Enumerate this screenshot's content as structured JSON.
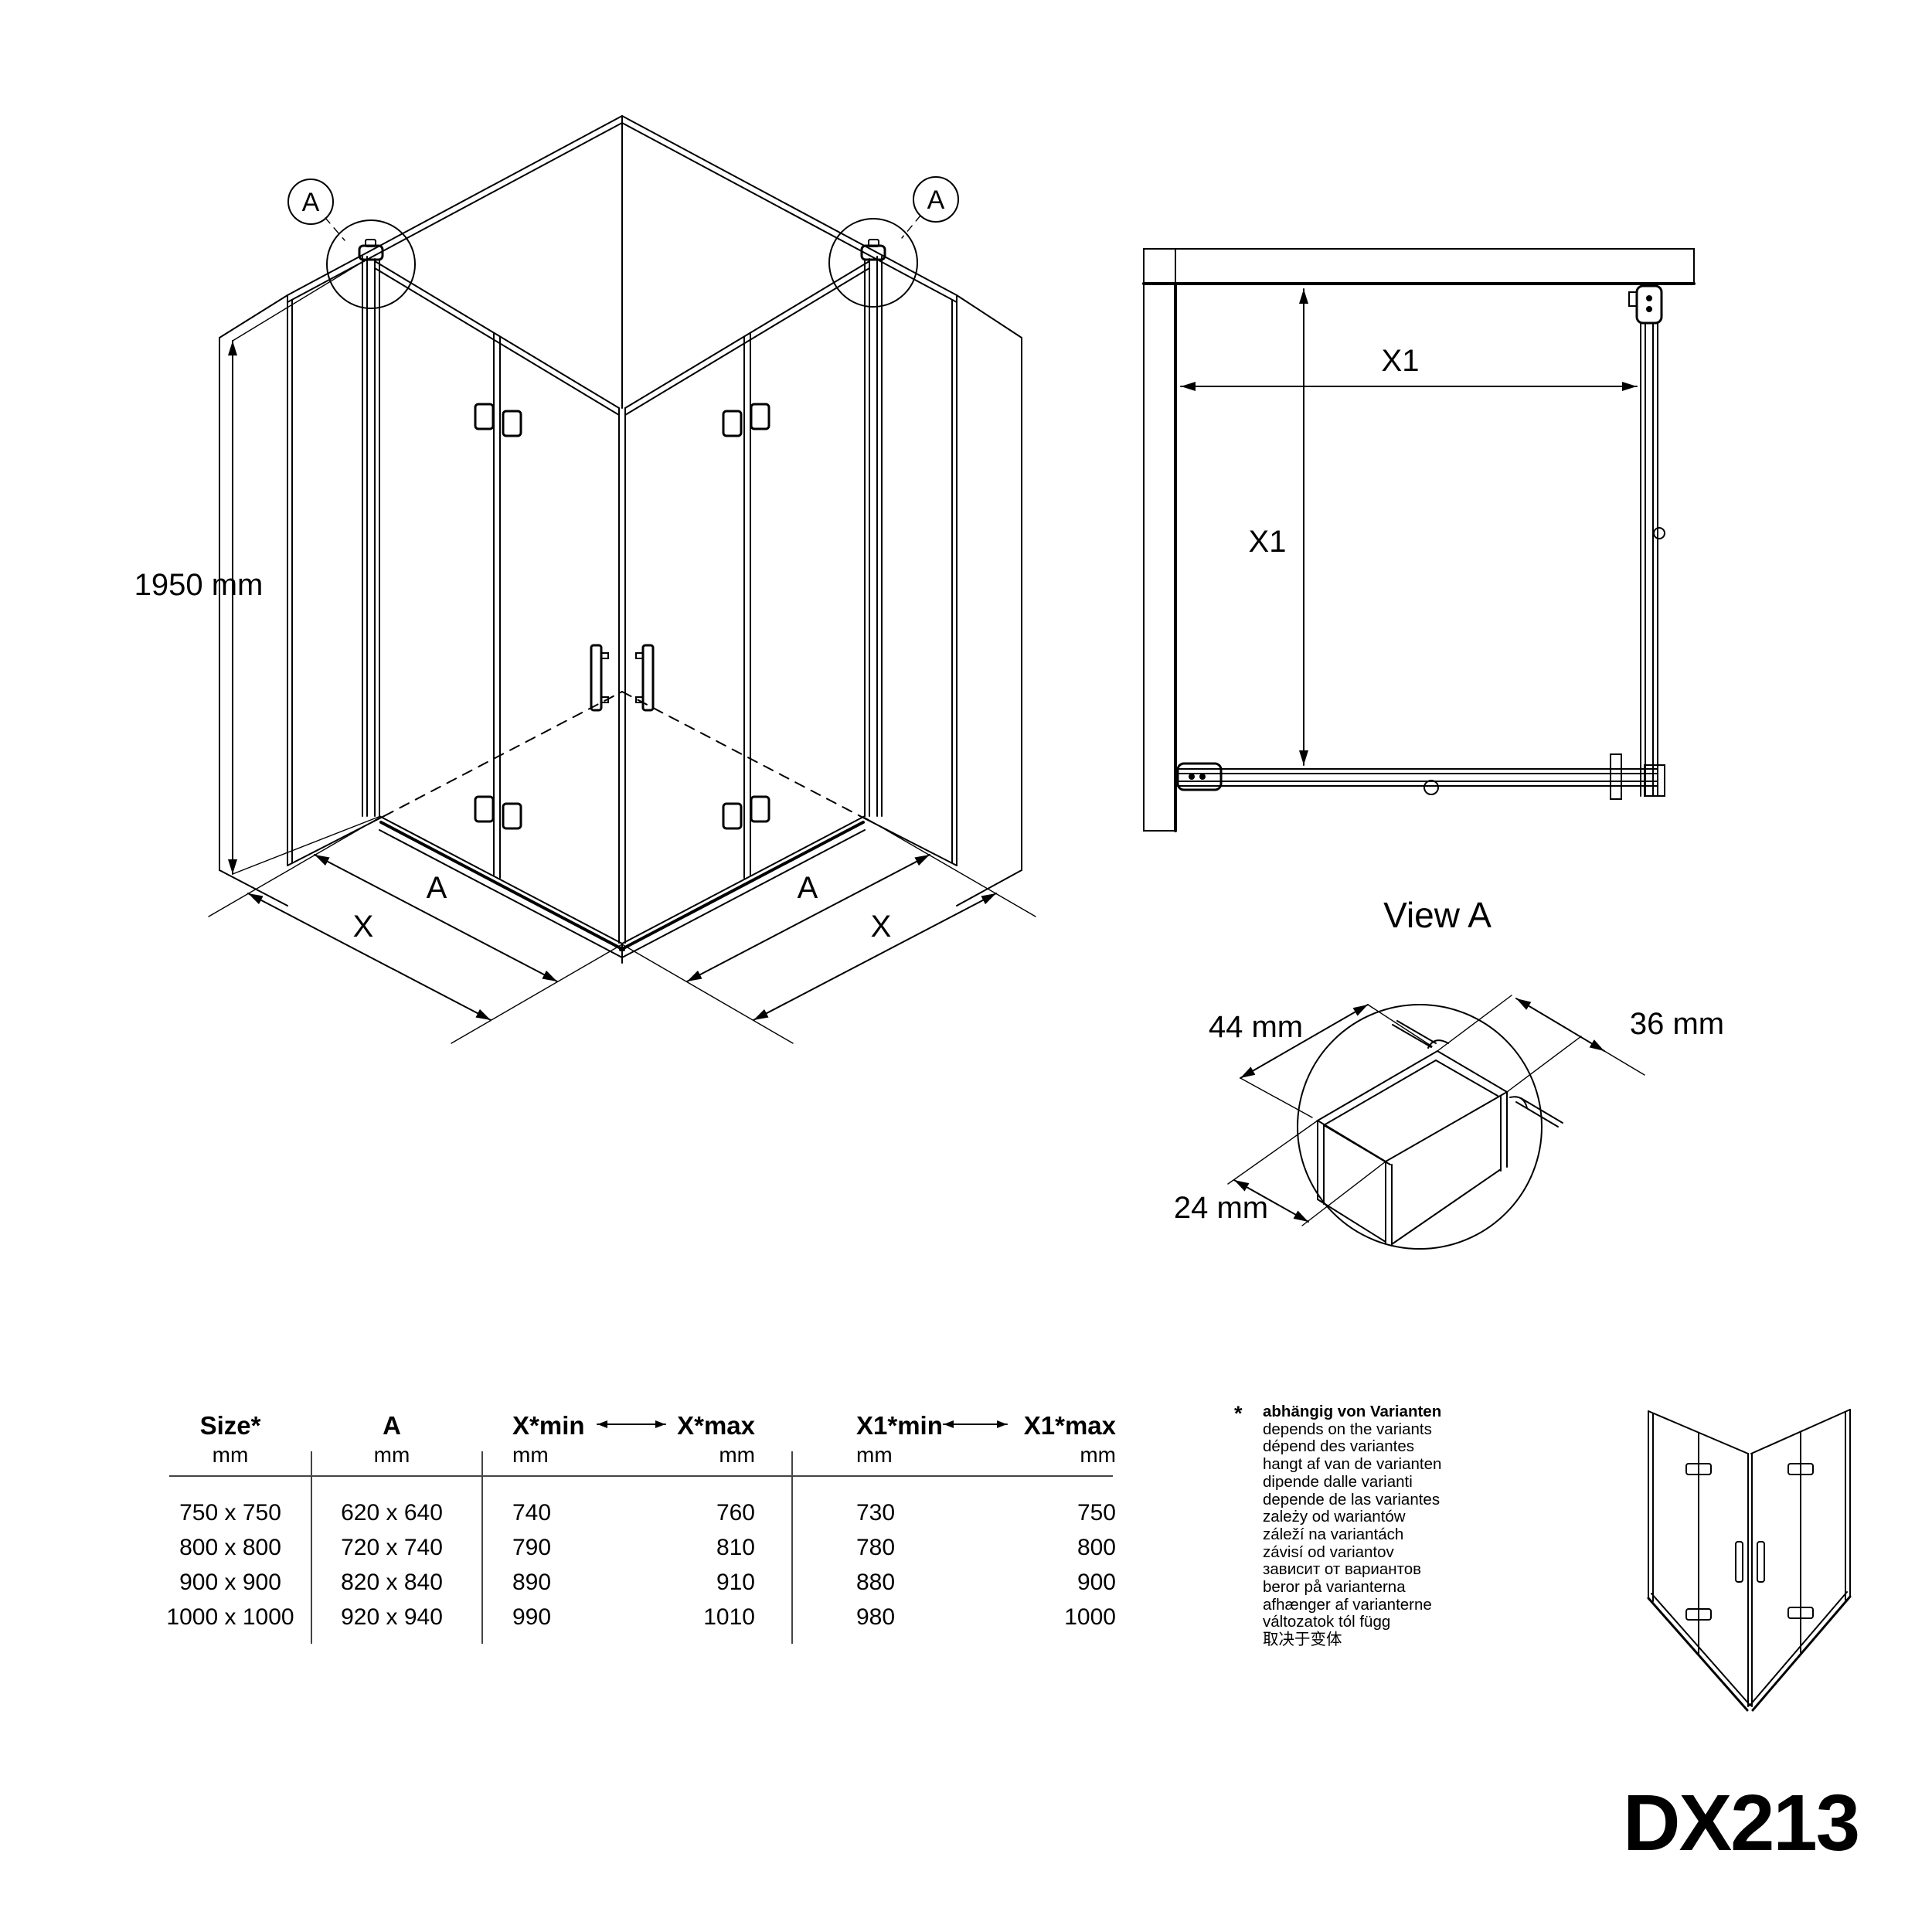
{
  "model": "DX213",
  "iso": {
    "balloon": "A",
    "height": "1950 mm",
    "dim_inner": "A",
    "dim_outer": "X"
  },
  "view_a": {
    "caption": "View A",
    "dim_horizontal": "X1",
    "dim_vertical": "X1"
  },
  "detail": {
    "dim_width": "44 mm",
    "dim_depth": "36 mm",
    "dim_thickness": "24 mm"
  },
  "table": {
    "headers": [
      "Size*",
      "A",
      "X*min",
      "X*max",
      "X1*min",
      "X1*max"
    ],
    "unit": "mm",
    "rows": [
      [
        "750 x 750",
        "620 x 640",
        "740",
        "760",
        "730",
        "750"
      ],
      [
        "800 x 800",
        "720 x 740",
        "790",
        "810",
        "780",
        "800"
      ],
      [
        "900 x 900",
        "820 x 840",
        "890",
        "910",
        "880",
        "900"
      ],
      [
        "1000 x 1000",
        "920 x 940",
        "990",
        "1010",
        "980",
        "1000"
      ]
    ]
  },
  "footnote": {
    "marker": "*",
    "lines": [
      "abhängig von Varianten",
      "depends on the variants",
      "dépend des variantes",
      "hangt af van de varianten",
      "dipende dalle varianti",
      "depende de las variantes",
      "zależy od wariantów",
      "záleží na variantách",
      "závisí od variantov",
      "зависит от вариантов",
      "beror på varianterna",
      "afhænger af varianterne",
      "változatok tól függ",
      "取决于变体"
    ]
  }
}
